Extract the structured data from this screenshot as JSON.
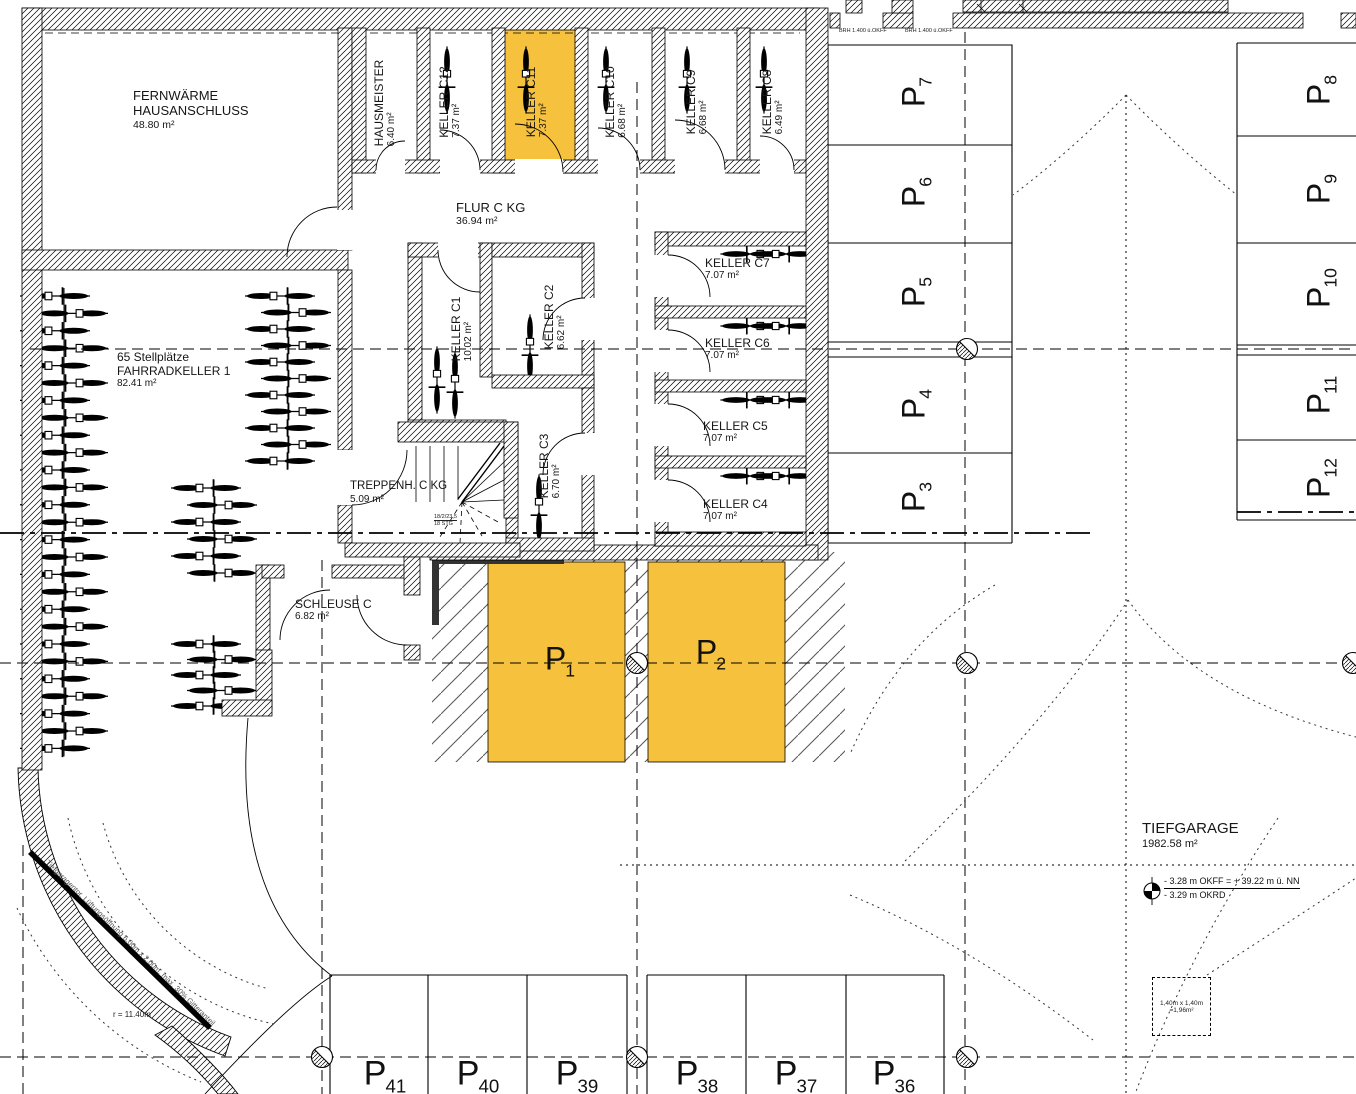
{
  "colors": {
    "highlight": "#F6C13C",
    "line": "#000000"
  },
  "rooms": {
    "fernwaerme": {
      "line1": "FERNWÄRME",
      "line2": "HAUSANSCHLUSS",
      "area": "48.80 m²"
    },
    "hausmeister": {
      "name": "HAUSMEISTER",
      "area": "6.40 m²"
    },
    "keller_c12": {
      "name": "KELLER C12",
      "area": "7.37 m²"
    },
    "keller_c11": {
      "name": "KELLER C11",
      "area": "7.37 m²",
      "highlighted": true
    },
    "keller_c10": {
      "name": "KELLER C10",
      "area": "6.68 m²"
    },
    "keller_c9": {
      "name": "KELLER C9",
      "area": "6.68 m²"
    },
    "keller_c8": {
      "name": "KELLER C8",
      "area": "6.49 m²"
    },
    "flur": {
      "name": "FLUR C KG",
      "area": "36.94 m²"
    },
    "keller_c1": {
      "name": "KELLER C1",
      "area": "10.02 m²"
    },
    "keller_c2": {
      "name": "KELLER C2",
      "area": "6.62 m²"
    },
    "keller_c3": {
      "name": "KELLER C3",
      "area": "6.70 m²"
    },
    "keller_c7": {
      "name": "KELLER C7",
      "area": "7.07 m²"
    },
    "keller_c6": {
      "name": "KELLER C6",
      "area": "7.07 m²"
    },
    "keller_c5": {
      "name": "KELLER C5",
      "area": "7.07 m²"
    },
    "keller_c4": {
      "name": "KELLER C4",
      "area": "7.07 m²"
    },
    "fahrradkeller": {
      "line1": "65 Stellplätze",
      "name": "FAHRRADKELLER 1",
      "area": "82.41 m²"
    },
    "treppenhaus": {
      "name": "TREPPENH. C KG",
      "area": "5.09 m²",
      "note1": "18/2/23,5",
      "note2": "18 STG"
    },
    "schleuse": {
      "name": "SCHLEUSE C",
      "area": "6.82 m²"
    },
    "tiefgarage": {
      "name": "TIEFGARAGE",
      "area": "1982.58 m²"
    }
  },
  "parking": {
    "prefix": "P",
    "p1": "1",
    "p2": "2",
    "p3": "3",
    "p4": "4",
    "p5": "5",
    "p6": "6",
    "p7": "7",
    "p8": "8",
    "p9": "9",
    "p10": "10",
    "p11": "11",
    "p12": "12",
    "p36": "36",
    "p37": "37",
    "p38": "38",
    "p39": "39",
    "p40": "40",
    "p41": "41"
  },
  "annotations": {
    "brh": "BRH 1.400 ü.OKFF",
    "level_line1": "- 3.28 m OKFF = + 39.22 m ü. NN",
    "level_line2": "- 3.29 m OKRD",
    "reserve_line1": "1,40m x 1,40m",
    "reserve_line2": "=1,96m²",
    "gate": "Tiefgaragentor, Lüftungsöffnung 6,00m x 2,00m, max. 30% Gitteranteil",
    "radius": "r = 11.40m"
  }
}
